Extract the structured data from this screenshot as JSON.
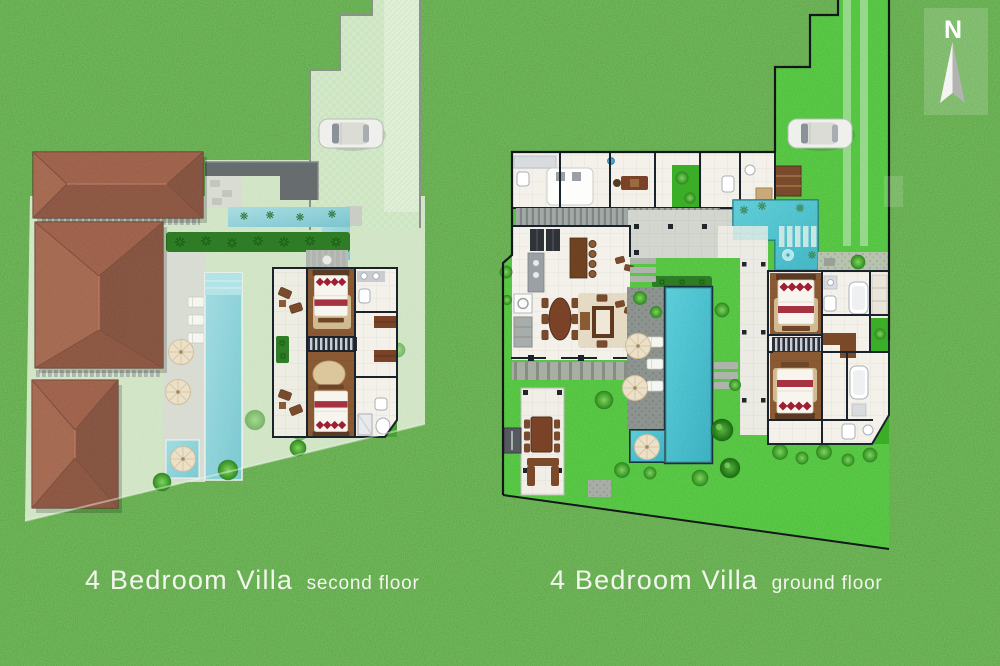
{
  "page": {
    "width": 1000,
    "height": 666,
    "description": "Villa resort site plan with two floor plans on grass"
  },
  "plans": {
    "left": {
      "title": "4 Bedroom Villa",
      "subtitle": "second floor"
    },
    "right": {
      "title": "4 Bedroom Villa",
      "subtitle": "ground floor"
    }
  },
  "compass": {
    "label": "N"
  },
  "colors": {
    "grass": "#47992f",
    "lawn": "#3bae27",
    "pale": "#c6dfb8",
    "pool": "#32b4c6",
    "pond": "#3cc0cd",
    "fadedpool": "#97d3d9",
    "roof": "#7c4130",
    "wood": "#8a5a34",
    "wall": "#1a222c",
    "path": "#a9aea6",
    "deck": "#d8dcd2",
    "umbrella": "#ece0c8",
    "red": "#9e1f32",
    "brown": "#7a4226",
    "flatroof": "#676d6f",
    "drive": "#bedcb0",
    "captiontext": "#f2f6ee"
  }
}
